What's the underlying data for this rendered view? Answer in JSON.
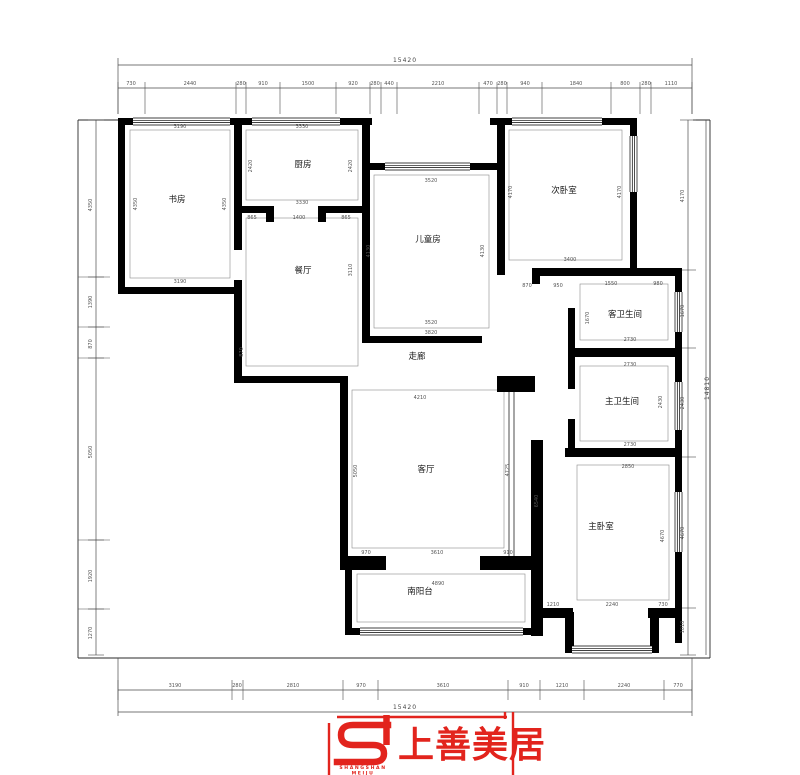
{
  "meta": {
    "drawing_type": "apartment floor plan",
    "wall_color": "#000000",
    "line_color": "#4a4a4a",
    "accent_red": "#e2241d"
  },
  "rooms": [
    {
      "label": "书房",
      "x": 177,
      "y": 202
    },
    {
      "label": "厨房",
      "x": 303,
      "y": 167
    },
    {
      "label": "餐厅",
      "x": 303,
      "y": 273
    },
    {
      "label": "儿童房",
      "x": 428,
      "y": 242
    },
    {
      "label": "次卧室",
      "x": 564,
      "y": 193
    },
    {
      "label": "客卫生间",
      "x": 625,
      "y": 317
    },
    {
      "label": "主卫生间",
      "x": 622,
      "y": 404
    },
    {
      "label": "走廊",
      "x": 417,
      "y": 359
    },
    {
      "label": "客厅",
      "x": 426,
      "y": 472
    },
    {
      "label": "主卧室",
      "x": 601,
      "y": 529
    },
    {
      "label": "南阳台",
      "x": 420,
      "y": 594
    }
  ],
  "dimensions": {
    "totals": [
      {
        "t": "15420",
        "x": 405,
        "y": 62
      },
      {
        "t": "15420",
        "x": 405,
        "y": 709
      },
      {
        "t": "14810",
        "x": 709,
        "y": 388,
        "r": 1
      }
    ],
    "top": [
      {
        "t": "730",
        "x": 131,
        "y": 85
      },
      {
        "t": "2440",
        "x": 190,
        "y": 85
      },
      {
        "t": "280",
        "x": 241,
        "y": 85
      },
      {
        "t": "910",
        "x": 263,
        "y": 85
      },
      {
        "t": "1500",
        "x": 308,
        "y": 85
      },
      {
        "t": "920",
        "x": 353,
        "y": 85
      },
      {
        "t": "280",
        "x": 375,
        "y": 85
      },
      {
        "t": "440",
        "x": 389,
        "y": 85
      },
      {
        "t": "2210",
        "x": 438,
        "y": 85
      },
      {
        "t": "470",
        "x": 488,
        "y": 85
      },
      {
        "t": "280",
        "x": 502,
        "y": 85
      },
      {
        "t": "940",
        "x": 525,
        "y": 85
      },
      {
        "t": "1840",
        "x": 576,
        "y": 85
      },
      {
        "t": "800",
        "x": 625,
        "y": 85
      },
      {
        "t": "280",
        "x": 646,
        "y": 85
      },
      {
        "t": "1110",
        "x": 671,
        "y": 85
      }
    ],
    "bottom": [
      {
        "t": "3190",
        "x": 175,
        "y": 687
      },
      {
        "t": "280",
        "x": 237,
        "y": 687
      },
      {
        "t": "2810",
        "x": 293,
        "y": 687
      },
      {
        "t": "970",
        "x": 361,
        "y": 687
      },
      {
        "t": "3610",
        "x": 443,
        "y": 687
      },
      {
        "t": "910",
        "x": 524,
        "y": 687
      },
      {
        "t": "1210",
        "x": 562,
        "y": 687
      },
      {
        "t": "2240",
        "x": 624,
        "y": 687
      },
      {
        "t": "770",
        "x": 678,
        "y": 687
      }
    ],
    "left": [
      {
        "t": "4350",
        "x": 92,
        "y": 205,
        "r": 1
      },
      {
        "t": "1390",
        "x": 92,
        "y": 302,
        "r": 1
      },
      {
        "t": "870",
        "x": 92,
        "y": 344,
        "r": 1
      },
      {
        "t": "5050",
        "x": 92,
        "y": 452,
        "r": 1
      },
      {
        "t": "1920",
        "x": 92,
        "y": 576,
        "r": 1
      },
      {
        "t": "1270",
        "x": 92,
        "y": 633,
        "r": 1
      }
    ],
    "right": [
      {
        "t": "4170",
        "x": 684,
        "y": 196,
        "r": 1
      },
      {
        "t": "1670",
        "x": 684,
        "y": 311,
        "r": 1
      },
      {
        "t": "2430",
        "x": 684,
        "y": 403,
        "r": 1
      },
      {
        "t": "4670",
        "x": 684,
        "y": 533,
        "r": 1
      },
      {
        "t": "1010",
        "x": 684,
        "y": 627,
        "r": 1
      }
    ],
    "interior": [
      {
        "t": "3190",
        "x": 180,
        "y": 128
      },
      {
        "t": "3190",
        "x": 180,
        "y": 283
      },
      {
        "t": "4350",
        "x": 137,
        "y": 204,
        "r": 1
      },
      {
        "t": "4350",
        "x": 226,
        "y": 204,
        "r": 1
      },
      {
        "t": "3330",
        "x": 302,
        "y": 128
      },
      {
        "t": "3330",
        "x": 302,
        "y": 204
      },
      {
        "t": "2420",
        "x": 252,
        "y": 166,
        "r": 1
      },
      {
        "t": "2420",
        "x": 352,
        "y": 166,
        "r": 1
      },
      {
        "t": "865",
        "x": 252,
        "y": 219
      },
      {
        "t": "1400",
        "x": 299,
        "y": 219
      },
      {
        "t": "865",
        "x": 346,
        "y": 219
      },
      {
        "t": "3110",
        "x": 352,
        "y": 270,
        "r": 1
      },
      {
        "t": "870",
        "x": 243,
        "y": 352,
        "r": 1
      },
      {
        "t": "3520",
        "x": 431,
        "y": 182
      },
      {
        "t": "3520",
        "x": 431,
        "y": 324
      },
      {
        "t": "3820",
        "x": 431,
        "y": 334
      },
      {
        "t": "4130",
        "x": 370,
        "y": 251,
        "r": 1
      },
      {
        "t": "4130",
        "x": 484,
        "y": 251,
        "r": 1
      },
      {
        "t": "4170",
        "x": 512,
        "y": 192,
        "r": 1
      },
      {
        "t": "4170",
        "x": 621,
        "y": 192,
        "r": 1
      },
      {
        "t": "3400",
        "x": 570,
        "y": 261
      },
      {
        "t": "870",
        "x": 527,
        "y": 287
      },
      {
        "t": "950",
        "x": 558,
        "y": 287
      },
      {
        "t": "1550",
        "x": 611,
        "y": 285
      },
      {
        "t": "980",
        "x": 658,
        "y": 285
      },
      {
        "t": "1670",
        "x": 589,
        "y": 318,
        "r": 1
      },
      {
        "t": "2730",
        "x": 630,
        "y": 341
      },
      {
        "t": "2730",
        "x": 630,
        "y": 366
      },
      {
        "t": "2430",
        "x": 662,
        "y": 402,
        "r": 1
      },
      {
        "t": "2730",
        "x": 630,
        "y": 446
      },
      {
        "t": "4210",
        "x": 420,
        "y": 399
      },
      {
        "t": "5050",
        "x": 357,
        "y": 471,
        "r": 1
      },
      {
        "t": "4725",
        "x": 509,
        "y": 470,
        "r": 1
      },
      {
        "t": "6540",
        "x": 538,
        "y": 501,
        "r": 1
      },
      {
        "t": "970",
        "x": 366,
        "y": 554
      },
      {
        "t": "3610",
        "x": 437,
        "y": 554
      },
      {
        "t": "910",
        "x": 508,
        "y": 554
      },
      {
        "t": "4890",
        "x": 438,
        "y": 585
      },
      {
        "t": "2850",
        "x": 628,
        "y": 468
      },
      {
        "t": "4670",
        "x": 664,
        "y": 536,
        "r": 1
      },
      {
        "t": "1210",
        "x": 553,
        "y": 606
      },
      {
        "t": "2240",
        "x": 612,
        "y": 606
      },
      {
        "t": "730",
        "x": 663,
        "y": 606
      }
    ]
  },
  "logo": {
    "name": "上善美居",
    "sub1": "SHANGSHAN",
    "sub2": "MEIJU"
  }
}
